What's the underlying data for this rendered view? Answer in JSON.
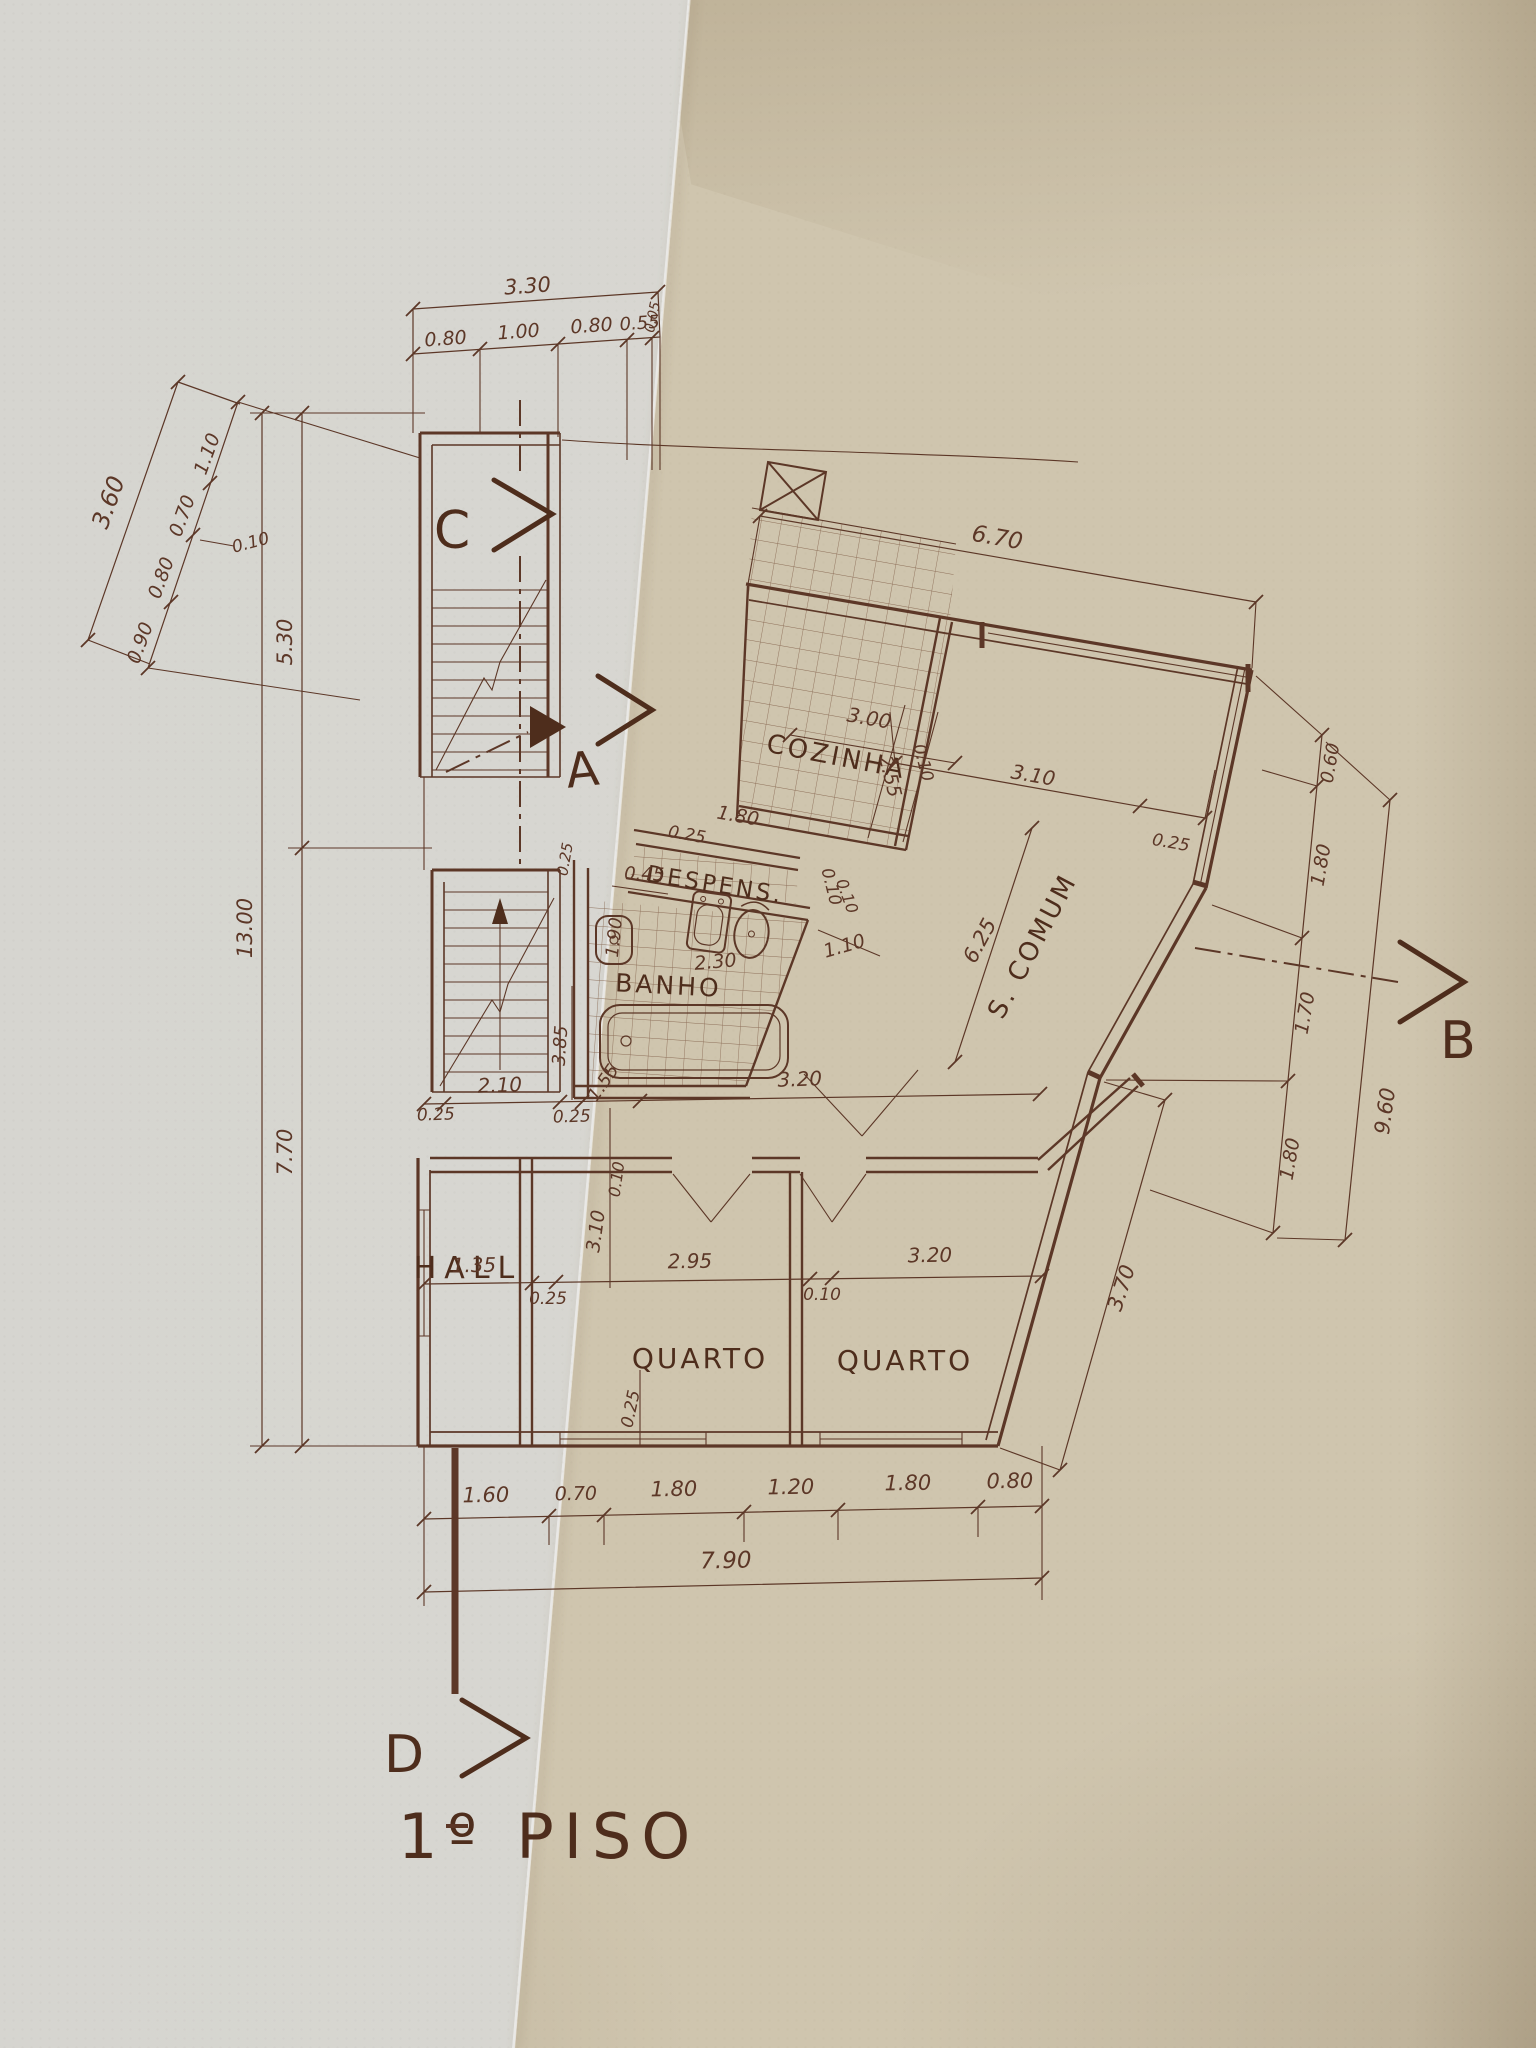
{
  "labels": {
    "title": "1º PISO",
    "marker_a": "A",
    "marker_b": "B",
    "marker_c": "C",
    "marker_d": "D",
    "cozinha": "COZINHA",
    "despensa": "DESPENS.",
    "banho": "BANHO",
    "sala_comum": "S. COMUM",
    "hall": "HALL",
    "quarto_left": "QUARTO",
    "quarto_right": "QUARTO"
  },
  "dims": {
    "top_total": "3.30",
    "top_1": "0.80",
    "top_2": "1.00",
    "top_3": "0.80",
    "top_4": "0.55",
    "top_5": "0.05",
    "diag_total": "3.60",
    "diag_1": "1.10",
    "diag_2": "0.70",
    "diag_3": "0.10",
    "diag_4": "0.80",
    "diag_5": "0.90",
    "left_total": "13.00",
    "left_upper": "5.30",
    "left_lower": "7.70",
    "top_right_total": "6.70",
    "sala_top_1": "3.10",
    "sala_top_2": "0.25",
    "kitchen_w": "3.00",
    "kitchen_d1": "2.55",
    "kitchen_d2": "0.10",
    "pantry_w": "1.80",
    "pantry_g": "0.25",
    "pantry_r": "0.10",
    "bath_1": "0.45",
    "bath_2": "1.90",
    "bath_3": "2.30",
    "bath_4": "1.10",
    "bath_5": "0.10",
    "bath_6": "0.25",
    "mid_1": "2.10",
    "mid_2": "0.25",
    "mid_3": "0.25",
    "mid_4": "1.55",
    "mid_5": "3.20",
    "mid_6": "3.85",
    "mid_v1": "3.10",
    "mid_v2": "0.10",
    "sala_diag": "6.25",
    "right_1": "0.60",
    "right_2": "1.80",
    "right_3": "1.70",
    "right_4": "1.80",
    "right_total": "9.60",
    "right_lower": "3.70",
    "row_1": "1.35",
    "row_2": "2.95",
    "row_3": "3.20",
    "row_g1": "0.25",
    "row_g2": "0.10",
    "row_v": "0.25",
    "bottom_1": "1.60",
    "bottom_2": "0.70",
    "bottom_3": "1.80",
    "bottom_4": "1.20",
    "bottom_5": "1.80",
    "bottom_6": "0.80",
    "bottom_total": "7.90"
  },
  "colors": {
    "ink": "#5c3727",
    "ink_dark": "#4e2d1c",
    "paper_left": "#d9d8d2",
    "paper_right": "#cfc5ae",
    "paper_corner": "#bdb096"
  }
}
